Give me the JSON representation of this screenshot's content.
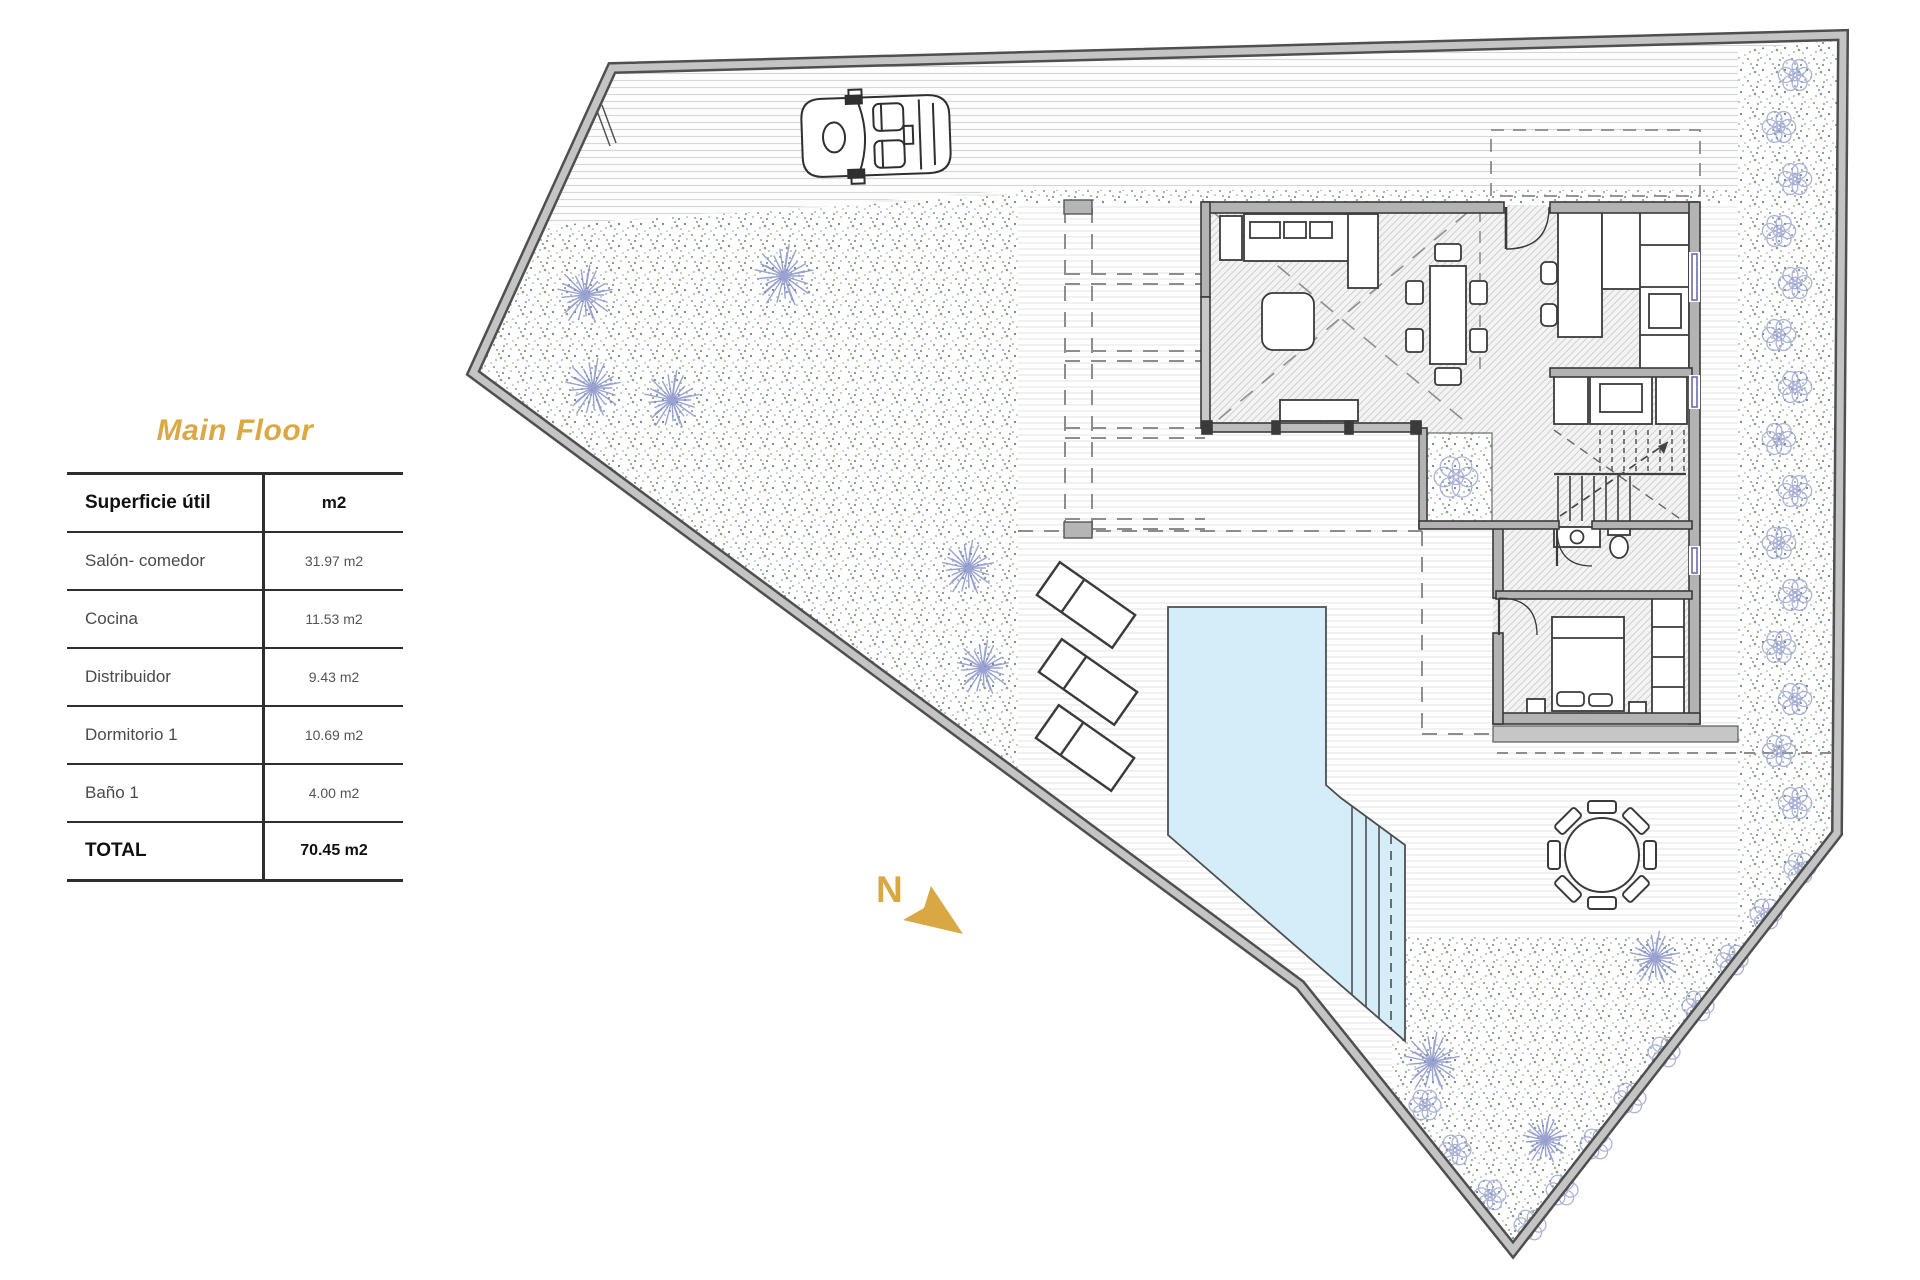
{
  "panel": {
    "title": "Main Floor",
    "title_color": "#DCA843",
    "table": {
      "headers": [
        "Superficie útil",
        "m2"
      ],
      "rows": [
        {
          "label": "Salón- comedor",
          "value": "31.97 m2"
        },
        {
          "label": "Cocina",
          "value": "11.53 m2"
        },
        {
          "label": "Distribuidor",
          "value": "9.43 m2"
        },
        {
          "label": "Dormitorio 1",
          "value": "10.69 m2"
        },
        {
          "label": "Baño 1",
          "value": "4.00 m2"
        }
      ],
      "total": {
        "label": "TOTAL",
        "value": "70.45 m2"
      }
    }
  },
  "plan": {
    "north_label": "N",
    "colors": {
      "accent_gold": "#D9A845",
      "pool_fill": "#D4EDF8",
      "tree_stroke": "#8A93CB",
      "shrub_stroke": "#98A0CF",
      "wall_dark": "#3A3A3A",
      "boundary_gray": "#C4C4C4"
    }
  }
}
